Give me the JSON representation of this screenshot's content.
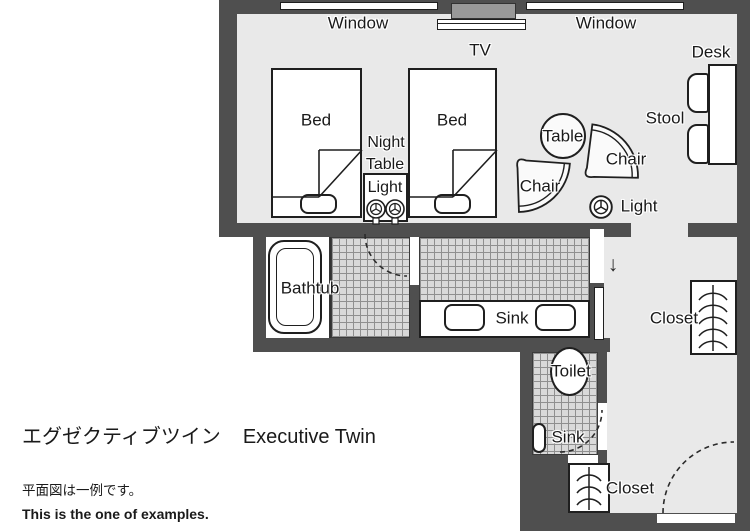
{
  "colors": {
    "wall": "#4f4f4f",
    "floor": "#e9e9e9",
    "tile": "#d9d9d9",
    "outline": "#1f1f1f",
    "text": "#1a1a1a"
  },
  "labels": {
    "window": "Window",
    "tv": "TV",
    "desk": "Desk",
    "stool": "Stool",
    "bed": "Bed",
    "night_table_light": {
      "line1": "Night",
      "line2": "Table",
      "line3": "Light"
    },
    "table": "Table",
    "chair": "Chair",
    "light": "Light",
    "bathtub": "Bathtub",
    "sink": "Sink",
    "toilet": "Toilet",
    "closet": "Closet",
    "entry_arrow": "↓"
  },
  "title": {
    "ja": "エグゼクティブツイン",
    "en": "Executive Twin"
  },
  "notes": {
    "ja": "平面図は一例です。",
    "en": "This is the one of examples."
  }
}
